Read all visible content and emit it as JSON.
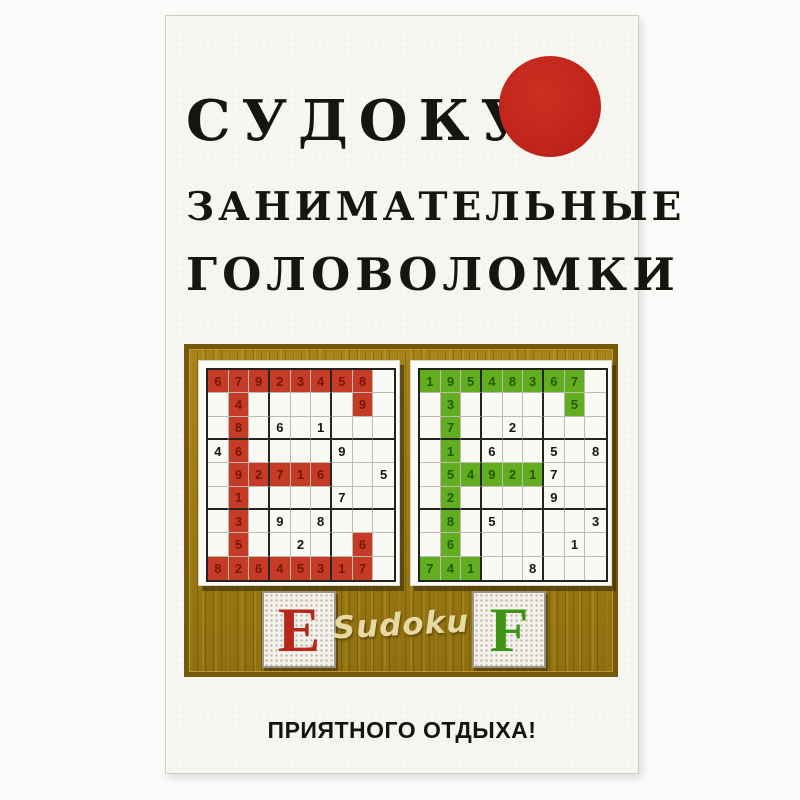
{
  "cover": {
    "title_lines": [
      "СУДОКУ",
      "ЗАНИМАТЕЛЬНЫЕ",
      "ГОЛОВОЛОМКИ"
    ],
    "tagline": "ПРИЯТНОГО ОТДЫХА!"
  },
  "panel": {
    "script_label": "Sudoku",
    "plaque_left_letter": "E",
    "plaque_right_letter": "F"
  },
  "colors": {
    "sun_red": "#c0241a",
    "wood_brown": "#9c7a10",
    "red_cell": "#c63b26",
    "red_digit": "#77150a",
    "green_cell": "#63ad21",
    "green_digit": "#245c06",
    "cover_background": "#f8f6f1"
  },
  "grids": {
    "left": {
      "letter_shape": "E",
      "cell_color": "#c63b26",
      "digit_color": "#77150a",
      "values": [
        [
          "6",
          "7",
          "9",
          "2",
          "3",
          "4",
          "5",
          "8",
          ""
        ],
        [
          "",
          "4",
          "",
          "",
          "",
          "",
          "",
          "9",
          ""
        ],
        [
          "",
          "8",
          "",
          "6",
          "",
          "1",
          "",
          "",
          ""
        ],
        [
          "4",
          "6",
          "",
          "",
          "",
          "",
          "9",
          "",
          ""
        ],
        [
          "",
          "9",
          "2",
          "7",
          "1",
          "6",
          "",
          "",
          "5"
        ],
        [
          "",
          "1",
          "",
          "",
          "",
          "",
          "7",
          "",
          ""
        ],
        [
          "",
          "3",
          "",
          "9",
          "",
          "8",
          "",
          "",
          ""
        ],
        [
          "",
          "5",
          "",
          "",
          "2",
          "",
          "",
          "6",
          ""
        ],
        [
          "8",
          "2",
          "6",
          "4",
          "5",
          "3",
          "1",
          "7",
          ""
        ]
      ],
      "mask": [
        [
          1,
          1,
          1,
          1,
          1,
          1,
          1,
          1,
          0
        ],
        [
          0,
          1,
          0,
          0,
          0,
          0,
          0,
          1,
          0
        ],
        [
          0,
          1,
          0,
          0,
          0,
          0,
          0,
          0,
          0
        ],
        [
          0,
          1,
          0,
          0,
          0,
          0,
          0,
          0,
          0
        ],
        [
          0,
          1,
          1,
          1,
          1,
          1,
          0,
          0,
          0
        ],
        [
          0,
          1,
          0,
          0,
          0,
          0,
          0,
          0,
          0
        ],
        [
          0,
          1,
          0,
          0,
          0,
          0,
          0,
          0,
          0
        ],
        [
          0,
          1,
          0,
          0,
          0,
          0,
          0,
          1,
          0
        ],
        [
          1,
          1,
          1,
          1,
          1,
          1,
          1,
          1,
          0
        ]
      ]
    },
    "right": {
      "letter_shape": "F",
      "cell_color": "#63ad21",
      "digit_color": "#245c06",
      "values": [
        [
          "1",
          "9",
          "5",
          "4",
          "8",
          "3",
          "6",
          "7",
          ""
        ],
        [
          "",
          "3",
          "",
          "",
          "",
          "",
          "",
          "5",
          ""
        ],
        [
          "",
          "7",
          "",
          "",
          "2",
          "",
          "",
          "",
          ""
        ],
        [
          "",
          "1",
          "",
          "6",
          "",
          "",
          "5",
          "",
          "8"
        ],
        [
          "",
          "5",
          "4",
          "9",
          "2",
          "1",
          "7",
          "",
          ""
        ],
        [
          "",
          "2",
          "",
          "",
          "",
          "",
          "9",
          "",
          ""
        ],
        [
          "",
          "8",
          "",
          "5",
          "",
          "",
          "",
          "",
          "3"
        ],
        [
          "",
          "6",
          "",
          "",
          "",
          "",
          "",
          "1",
          ""
        ],
        [
          "7",
          "4",
          "1",
          "",
          "",
          "8",
          "",
          "",
          ""
        ]
      ],
      "mask": [
        [
          1,
          1,
          1,
          1,
          1,
          1,
          1,
          1,
          0
        ],
        [
          0,
          1,
          0,
          0,
          0,
          0,
          0,
          1,
          0
        ],
        [
          0,
          1,
          0,
          0,
          0,
          0,
          0,
          0,
          0
        ],
        [
          0,
          1,
          0,
          0,
          0,
          0,
          0,
          0,
          0
        ],
        [
          0,
          1,
          1,
          1,
          1,
          1,
          0,
          0,
          0
        ],
        [
          0,
          1,
          0,
          0,
          0,
          0,
          0,
          0,
          0
        ],
        [
          0,
          1,
          0,
          0,
          0,
          0,
          0,
          0,
          0
        ],
        [
          0,
          1,
          0,
          0,
          0,
          0,
          0,
          0,
          0
        ],
        [
          1,
          1,
          1,
          0,
          0,
          0,
          0,
          0,
          0
        ]
      ]
    }
  }
}
